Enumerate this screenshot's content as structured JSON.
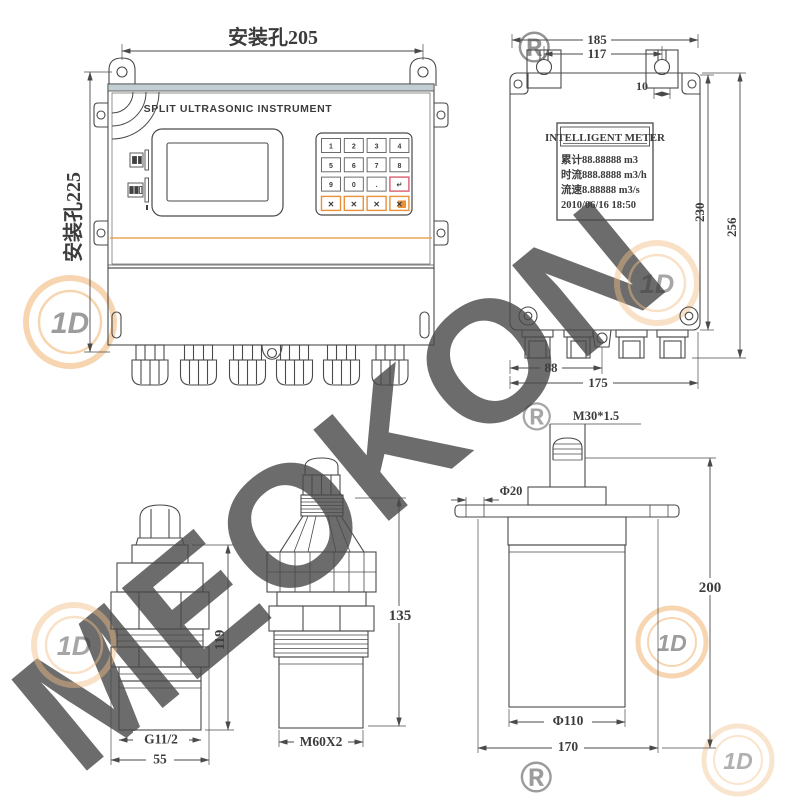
{
  "front_view": {
    "dim_mount_width": "安装孔205",
    "dim_mount_height": "安装孔225",
    "title": "SPLIT ULTRASONIC INSTRUMENT",
    "keypad": {
      "keys": [
        "1",
        "2",
        "3",
        "4",
        "5",
        "6",
        "7",
        "8",
        "9",
        "0",
        ".",
        "↵"
      ],
      "function_keys": [
        "✕",
        "✕",
        "✕",
        "✕"
      ]
    }
  },
  "rear_view": {
    "lcd": {
      "title": "INTELLIGENT METER",
      "line1": "累计88.88888  m3",
      "line2": "时流888.8888 m3/h",
      "line3": "流速8.88888  m3/s",
      "line4": "2010/06/16 18:50"
    },
    "dims": {
      "overall_width": "185",
      "hole_spacing": "117",
      "bracket_slot": "10",
      "body_height": "230",
      "overall_height": "256",
      "gland_offset": "88",
      "bottom_width": "175"
    }
  },
  "sensors": {
    "small": {
      "height": "119",
      "thread": "G11/2",
      "width": "55"
    },
    "medium": {
      "height": "135",
      "thread": "M60X2"
    },
    "large": {
      "top_thread": "M30*1.5",
      "stem_dia": "Φ20",
      "height": "200",
      "body_dia": "Φ110",
      "flange_width": "170"
    }
  },
  "watermark": {
    "brand": "MEOKON",
    "registered": "®",
    "logo_monogram": "1D"
  },
  "colors": {
    "line": "#3f3f3f",
    "accent_orange": "#E8913A",
    "enter_key_border": "#D95F6E",
    "watermark_light": "#FAE9D2",
    "watermark_mid": "#F2BE84"
  }
}
